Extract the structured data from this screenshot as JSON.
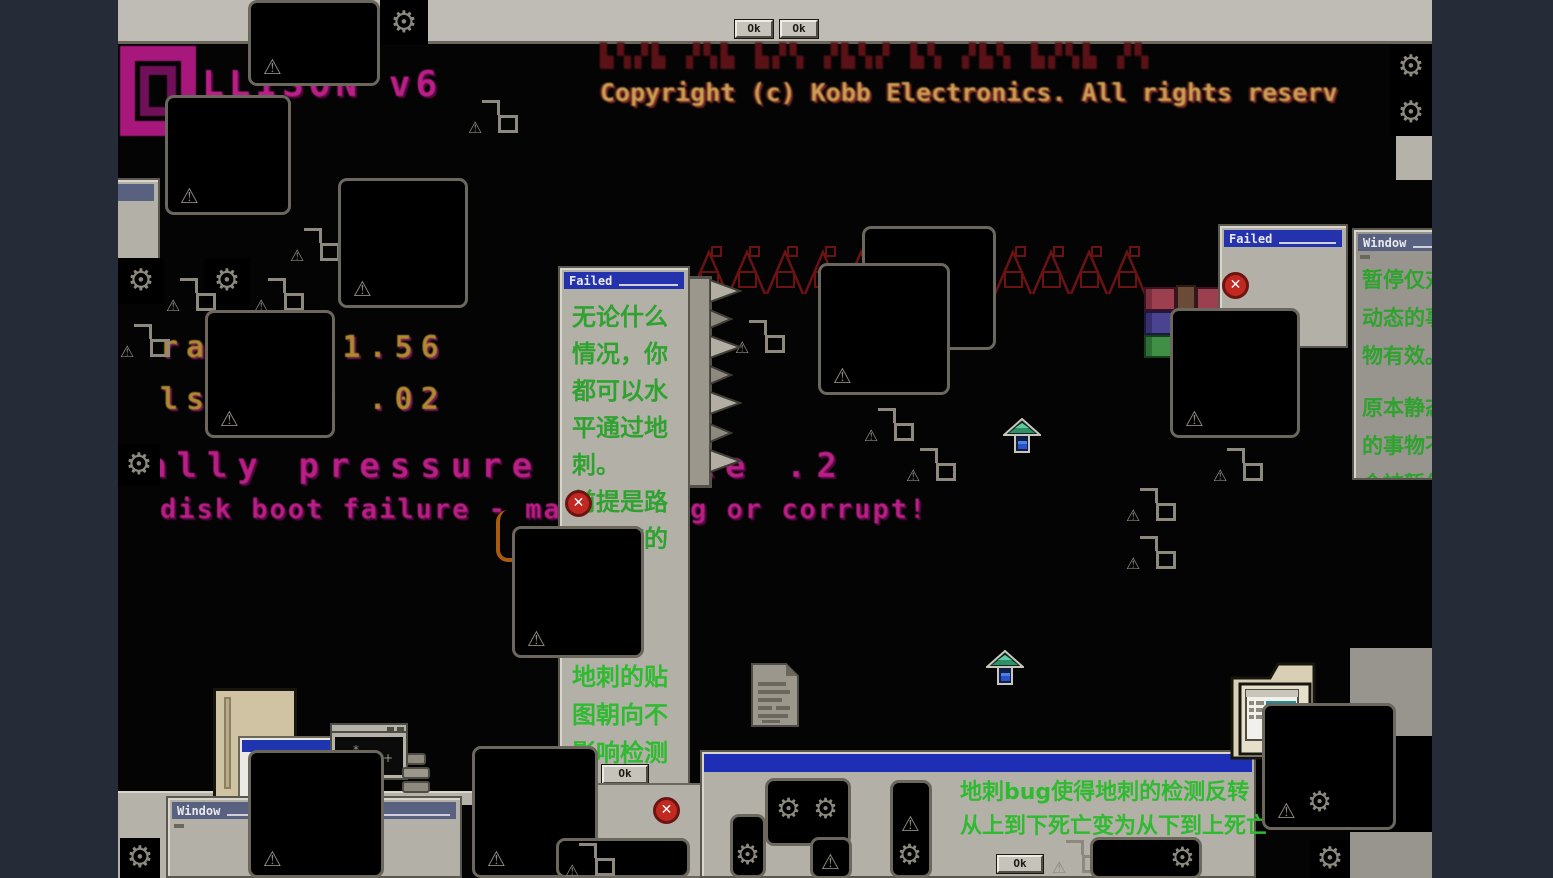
{
  "icons": {
    "gear": "⚙",
    "warning": "⚠",
    "close": "✕",
    "asterisk": "*",
    "plus": "+"
  },
  "colors": {
    "letterbox": "#252b37",
    "viewport_bg": "#040404",
    "window_gray": "#b3b0a8",
    "title_blue": "#2433ad",
    "title_slate": "#58617f",
    "text_green": "#2fa22f",
    "glitch_magenta": "#bb1f87",
    "spike_red": "#6b1212",
    "error_red": "#c02820"
  },
  "top_bar": {
    "ok_1": "Ok",
    "ok_2": "Ok"
  },
  "boot_screen": {
    "title": "LLISON v6",
    "glitch_line": "▙▚▞▙ ▞▚▙ ▙▞▚ ▞▙▚▞ ▙▚ ▞▙▚ ▙▞▚▙ ▞▚",
    "copyright": "Copyright (c) Kobb Electronics. All rights reserv",
    "mem_line_1": "ra▚▚ ▚ 1.56",
    "mem_line_2": "ls▚▚ ▚0 .02",
    "status_line": "ally pressure module .2",
    "error_line_left": "disk boot failure - mak",
    "error_line_right": "g or corrupt!"
  },
  "dialog_failed": {
    "title": "Failed",
    "message_1": [
      "无论什么",
      "情况，你",
      "都可以水",
      "平通过地",
      "刺。",
      "前提是路",
      "是平整的"
    ],
    "message_2": [
      "地刺的贴",
      "图朝向不",
      "影响检测"
    ],
    "ok_label": "Ok"
  },
  "window_failed_small": {
    "title": "Failed"
  },
  "panel_pause": {
    "title": "Window",
    "paragraph_1": [
      "暂停仅对",
      "动态的事",
      "物有效。"
    ],
    "paragraph_2": [
      "原本静态",
      "的事物不",
      "会被暂停"
    ]
  },
  "window_bottom_left": {
    "title": "Window"
  },
  "window_bottom_center": {
    "line_1": "地刺bug使得地刺的检测反转",
    "line_2": "从上到下死亡变为从下到上死亡",
    "ok_label": "Ok"
  }
}
